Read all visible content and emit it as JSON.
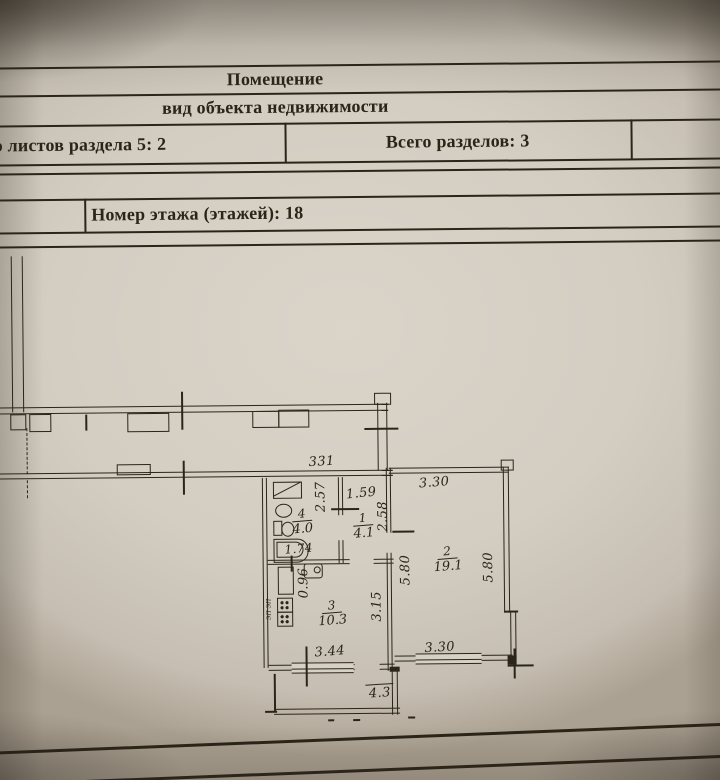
{
  "document": {
    "header": {
      "title": "Помещение",
      "subtitle": "вид объекта недвижимости",
      "sheets_in_section": "о листов раздела 5: 2",
      "total_sections": "Всего разделов: 3",
      "floor_number": "Номер этажа (этажей): 18"
    },
    "plan": {
      "rooms": {
        "room1": {
          "number": "1",
          "area": "4.1"
        },
        "room2": {
          "number": "2",
          "area": "19.1"
        },
        "room3": {
          "number": "3",
          "area": "10.3"
        },
        "room4": {
          "number": "4",
          "area": "4.0"
        }
      },
      "balcony": {
        "area": "4.3"
      },
      "dimensions": {
        "top_width": "331",
        "room2_top": "3.30",
        "bath_height": "2.57",
        "hall_width": "1.59",
        "hall_height": "2.58",
        "tub_length": "1.74",
        "counter": "0.96",
        "room2_left_height": "5.80",
        "room2_right_height": "5.80",
        "kitchen_right": "3.15",
        "kitchen_bottom": "3.44",
        "room2_bottom": "3.30"
      },
      "equipment": {
        "stove": "ЭП ЭП"
      }
    },
    "colors": {
      "paper": "#d7d1c6",
      "ink": "#2b2519"
    }
  }
}
